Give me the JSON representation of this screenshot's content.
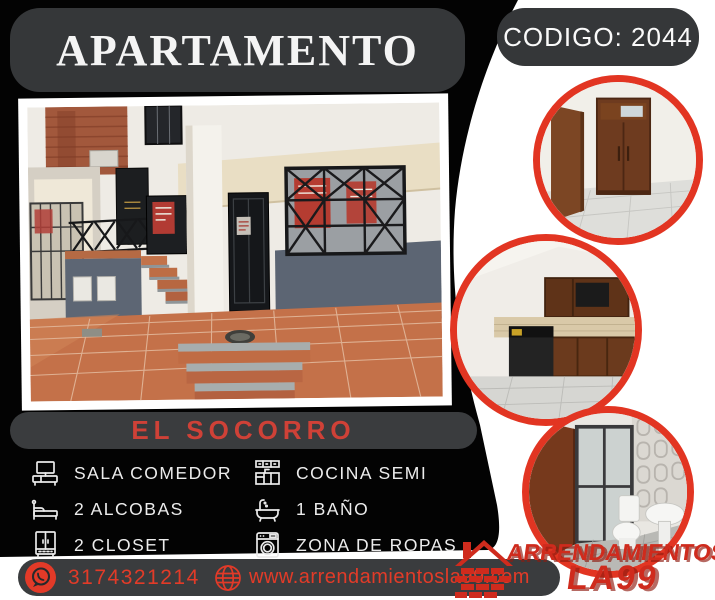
{
  "header": {
    "title": "APARTAMENTO",
    "code": "CODIGO: 2044"
  },
  "location": "EL SOCORRO",
  "features": {
    "left": [
      {
        "icon": "tv-console-icon",
        "label": "SALA COMEDOR"
      },
      {
        "icon": "bed-icon",
        "label": "2 ALCOBAS"
      },
      {
        "icon": "closet-icon",
        "label": "2 CLOSET"
      }
    ],
    "right": [
      {
        "icon": "kitchen-cabinets-icon",
        "label": "COCINA SEMI"
      },
      {
        "icon": "bathtub-icon",
        "label": "1 BAÑO"
      },
      {
        "icon": "washing-machine-icon",
        "label": "ZONA DE ROPAS"
      }
    ]
  },
  "contact": {
    "phone": "3174321214",
    "website": "www.arrendamientosla99.com"
  },
  "brand": {
    "name_line1": "ARRENDAMIENTOS",
    "name_line2": "LA99"
  },
  "colors": {
    "background": "#000000",
    "panel_gray": "#37393b",
    "accent_red": "#d63a2c",
    "circle_border": "#e23522"
  }
}
